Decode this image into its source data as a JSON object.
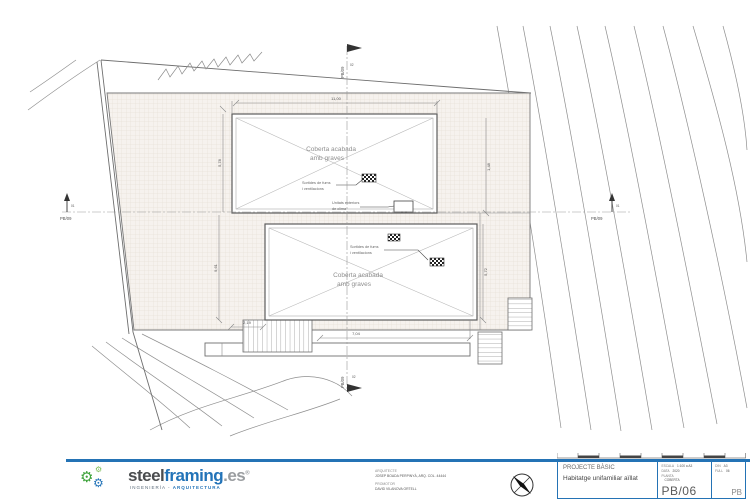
{
  "brand": {
    "steel": "steel",
    "framing": "framing",
    "tld": ".es",
    "reg": "®",
    "tagline_left": "INGENIERÍA",
    "tagline_sep": " - ",
    "tagline_right": "ARQUITECTURA"
  },
  "credits": {
    "architect_label": "ARQUITECTE",
    "architect_name": "JOSEP BOADA PERPINYÀ, ARQ. COL. 44444",
    "promoter_label": "PROMOTOR",
    "promoter_name": "DAVID VILANOVA ORTELL"
  },
  "titleblock": {
    "project_type": "PROJECTE BÀSIC",
    "project_title": "Habitatge unifamiliar aïllat",
    "scale_label": "ESCALA",
    "scale_value": "1:100 a A3",
    "date_label": "DATA",
    "date_value": "2020",
    "plan_label": "PLANTA",
    "plan_value": "COBERTA",
    "sheet_code": "PB/06",
    "din_label": "DIN",
    "din_value": "A3",
    "full_label": "FULL",
    "full_value": "06",
    "corner_code": "PB"
  },
  "plan": {
    "roof_label_line1": "Coberta acabada",
    "roof_label_line2": "amb graves",
    "vent_line1": "Sortides de fums",
    "vent_line2": "i ventilacions",
    "clima_line1": "Unitats exteriors",
    "clima_line2": "de clima",
    "dims": {
      "top": "11,00",
      "left_upper": "5,78",
      "left_lower": "9,61",
      "right_upper": "1,48",
      "right_lower": "5,72",
      "bottom_small": "2,19",
      "bottom": "7,04"
    },
    "section_ref": "PB/09",
    "section_num_h": "01",
    "section_num_v": "02"
  },
  "colors": {
    "accent_blue": "#2473b5",
    "logo_green": "#3fa33c",
    "line_gray": "#6e6e6e"
  }
}
